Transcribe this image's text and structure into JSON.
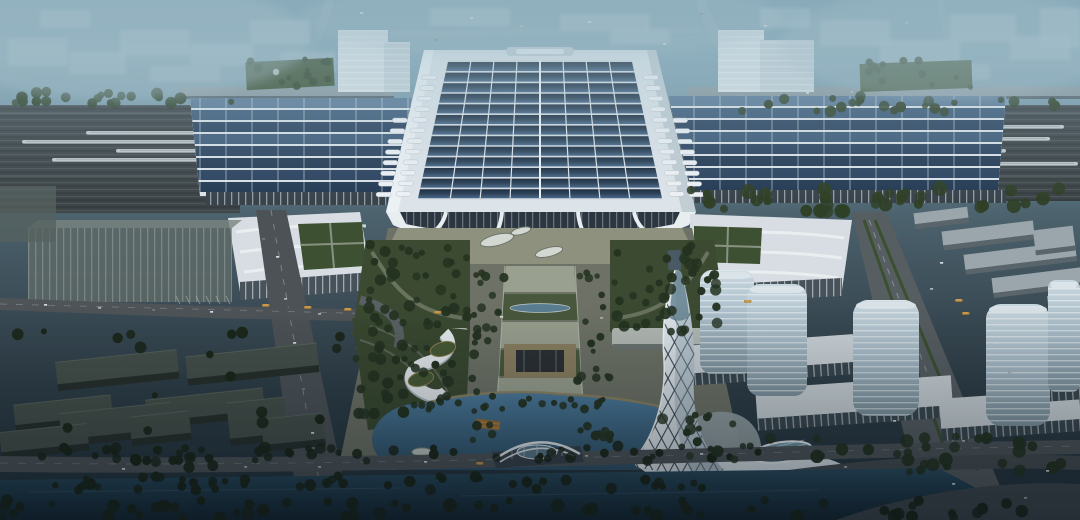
{
  "scene": {
    "title": "Aerial dusk rendering of a high-speed railway station complex",
    "landmarks": [
      "railway-station-hall",
      "solar-panel-roof",
      "side-platform-wings",
      "railway-tracks-with-trains",
      "flanking-office-buildings",
      "wave-roof-annexes",
      "central-garden-axis",
      "landscaped-lake",
      "arch-footbridge",
      "twisted-lattice-tower",
      "glass-high-rise-towers",
      "warehouse-district",
      "canal",
      "hazy-city-skyline"
    ]
  },
  "palette": {
    "sky_top": "#6f93a4",
    "haze_block": "#a9bfca",
    "track_bed": "#3d4447",
    "train_white": "#ced4d8",
    "roof_white": "#dde4e9",
    "panel_dark": "#2d4460",
    "panel_light": "#5c7a97",
    "glass_dark": "#2b3640",
    "garden_green": "#3b4a31",
    "tree_dark": "#243220",
    "tree_mid": "#2f4026",
    "tree_black": "#1a2518",
    "plaza_grey": "#6e7266",
    "axis_pale": "#9aa08f",
    "road_grey": "#4e5457",
    "lake_blue": "#4e7c9e",
    "canal_dark": "#1f3a4a",
    "tower_glass": "#a8bcc8",
    "white_building": "#d9e1e6",
    "lattice_white": "#e6edf1",
    "bus_orange": "#b5822f",
    "pond_blue": "#5d8196"
  },
  "station": {
    "solar_rows": 13,
    "solar_cols": 8,
    "wing_rows": 8,
    "axis": {
      "top": 266,
      "bottom": 462,
      "segments": 7
    }
  },
  "trains": [
    {
      "x": 86,
      "y": 131,
      "w": 212
    },
    {
      "x": 22,
      "y": 140,
      "w": 198
    },
    {
      "x": 116,
      "y": 149,
      "w": 212
    },
    {
      "x": 52,
      "y": 158,
      "w": 168
    },
    {
      "x": 884,
      "y": 125,
      "w": 180
    },
    {
      "x": 798,
      "y": 137,
      "w": 252
    },
    {
      "x": 748,
      "y": 149,
      "w": 258
    },
    {
      "x": 842,
      "y": 162,
      "w": 236
    }
  ],
  "haze_blocks": [
    {
      "x": 8,
      "y": 38,
      "w": 60,
      "h": 28
    },
    {
      "x": 70,
      "y": 52,
      "w": 56,
      "h": 22
    },
    {
      "x": 120,
      "y": 30,
      "w": 70,
      "h": 26
    },
    {
      "x": 190,
      "y": 44,
      "w": 64,
      "h": 22
    },
    {
      "x": 250,
      "y": 20,
      "w": 60,
      "h": 24
    },
    {
      "x": 280,
      "y": 52,
      "w": 56,
      "h": 20
    },
    {
      "x": 150,
      "y": 66,
      "w": 70,
      "h": 16
    },
    {
      "x": 40,
      "y": 10,
      "w": 50,
      "h": 18
    },
    {
      "x": 430,
      "y": 8,
      "w": 80,
      "h": 18
    },
    {
      "x": 560,
      "y": 14,
      "w": 90,
      "h": 16
    },
    {
      "x": 610,
      "y": 30,
      "w": 60,
      "h": 14
    },
    {
      "x": 820,
      "y": 20,
      "w": 70,
      "h": 26
    },
    {
      "x": 880,
      "y": 40,
      "w": 80,
      "h": 24
    },
    {
      "x": 950,
      "y": 14,
      "w": 66,
      "h": 28
    },
    {
      "x": 1010,
      "y": 36,
      "w": 60,
      "h": 24
    },
    {
      "x": 900,
      "y": 64,
      "w": 90,
      "h": 16
    },
    {
      "x": 1040,
      "y": 8,
      "w": 40,
      "h": 40
    },
    {
      "x": 760,
      "y": 8,
      "w": 50,
      "h": 20
    }
  ],
  "towers": [
    {
      "x": 700,
      "y": 270,
      "w": 54,
      "h": 104,
      "r": 12
    },
    {
      "x": 747,
      "y": 284,
      "w": 60,
      "h": 112,
      "r": 13
    },
    {
      "x": 853,
      "y": 300,
      "w": 66,
      "h": 116,
      "r": 15
    },
    {
      "x": 986,
      "y": 304,
      "w": 64,
      "h": 122,
      "r": 15
    },
    {
      "x": 1048,
      "y": 280,
      "w": 32,
      "h": 112,
      "r": 8
    }
  ],
  "podiums": [
    {
      "x": 684,
      "y": 340,
      "w": 170,
      "h": 28
    },
    {
      "x": 756,
      "y": 382,
      "w": 196,
      "h": 30
    },
    {
      "x": 940,
      "y": 394,
      "w": 140,
      "h": 30
    },
    {
      "x": 1002,
      "y": 368,
      "w": 78,
      "h": 22
    }
  ],
  "warehouses": [
    {
      "x": 942,
      "y": 226,
      "w": 92,
      "h": 14
    },
    {
      "x": 964,
      "y": 248,
      "w": 112,
      "h": 15
    },
    {
      "x": 992,
      "y": 272,
      "w": 102,
      "h": 15
    },
    {
      "x": 1034,
      "y": 228,
      "w": 40,
      "h": 20
    },
    {
      "x": 1048,
      "y": 294,
      "w": 32,
      "h": 18
    },
    {
      "x": 914,
      "y": 210,
      "w": 54,
      "h": 11
    }
  ],
  "slabs": [
    {
      "x": 56,
      "y": 356,
      "w": 122,
      "h": 22
    },
    {
      "x": 186,
      "y": 350,
      "w": 132,
      "h": 22
    },
    {
      "x": 146,
      "y": 394,
      "w": 118,
      "h": 22
    },
    {
      "x": 14,
      "y": 400,
      "w": 98,
      "h": 20
    },
    {
      "x": 60,
      "y": 408,
      "w": 112,
      "h": 26
    },
    {
      "x": 228,
      "y": 400,
      "w": 58,
      "h": 36
    },
    {
      "x": 262,
      "y": 416,
      "w": 62,
      "h": 26
    },
    {
      "x": 0,
      "y": 428,
      "w": 88,
      "h": 20
    },
    {
      "x": 130,
      "y": 414,
      "w": 60,
      "h": 22
    }
  ],
  "tree_clusters": [
    {
      "x": 0,
      "y": 90,
      "w": 240,
      "h": 14,
      "n": 22,
      "r0": 3,
      "r1": 6,
      "c": "m"
    },
    {
      "x": 700,
      "y": 96,
      "w": 380,
      "h": 16,
      "n": 24,
      "r0": 3,
      "r1": 6,
      "c": "m"
    },
    {
      "x": 688,
      "y": 188,
      "w": 392,
      "h": 24,
      "n": 34,
      "r0": 4,
      "r1": 8,
      "c": "m"
    },
    {
      "x": 362,
      "y": 244,
      "w": 106,
      "h": 88,
      "n": 40,
      "r0": 3,
      "r1": 6,
      "c": "d"
    },
    {
      "x": 614,
      "y": 244,
      "w": 104,
      "h": 88,
      "n": 40,
      "r0": 3,
      "r1": 6,
      "c": "d"
    },
    {
      "x": 472,
      "y": 268,
      "w": 34,
      "h": 186,
      "n": 26,
      "r0": 2.5,
      "r1": 5,
      "c": "d"
    },
    {
      "x": 576,
      "y": 268,
      "w": 34,
      "h": 186,
      "n": 26,
      "r0": 2.5,
      "r1": 5,
      "c": "d"
    },
    {
      "x": 354,
      "y": 334,
      "w": 108,
      "h": 84,
      "n": 34,
      "r0": 3,
      "r1": 6,
      "c": "d"
    },
    {
      "x": 432,
      "y": 396,
      "w": 196,
      "h": 12,
      "n": 18,
      "r0": 2.5,
      "r1": 4.5,
      "c": "d"
    },
    {
      "x": 0,
      "y": 446,
      "w": 770,
      "h": 16,
      "n": 56,
      "r0": 3,
      "r1": 6,
      "c": "k"
    },
    {
      "x": 0,
      "y": 476,
      "w": 710,
      "h": 14,
      "n": 48,
      "r0": 3,
      "r1": 6,
      "c": "k"
    },
    {
      "x": 0,
      "y": 500,
      "w": 1030,
      "h": 18,
      "n": 60,
      "r0": 3,
      "r1": 7,
      "c": "k"
    },
    {
      "x": 770,
      "y": 436,
      "w": 300,
      "h": 36,
      "n": 30,
      "r0": 3.5,
      "r1": 7,
      "c": "d"
    },
    {
      "x": 0,
      "y": 330,
      "w": 340,
      "h": 160,
      "n": 26,
      "r0": 3,
      "r1": 6,
      "c": "k"
    },
    {
      "x": 240,
      "y": 56,
      "w": 92,
      "h": 30,
      "n": 12,
      "r0": 2.5,
      "r1": 5,
      "c": "m"
    },
    {
      "x": 856,
      "y": 60,
      "w": 120,
      "h": 30,
      "n": 12,
      "r0": 2.5,
      "r1": 5,
      "c": "m"
    },
    {
      "x": 660,
      "y": 412,
      "w": 100,
      "h": 50,
      "n": 16,
      "r0": 3,
      "r1": 6,
      "c": "d"
    }
  ],
  "cars": [
    {
      "x": 470,
      "y": 17,
      "c": 0
    },
    {
      "x": 520,
      "y": 25,
      "c": 1
    },
    {
      "x": 588,
      "y": 21,
      "c": 0
    },
    {
      "x": 645,
      "y": 29,
      "c": 1
    },
    {
      "x": 700,
      "y": 13,
      "c": 2
    },
    {
      "x": 764,
      "y": 25,
      "c": 0
    },
    {
      "x": 822,
      "y": 33,
      "c": 1
    },
    {
      "x": 434,
      "y": 39,
      "c": 2
    },
    {
      "x": 663,
      "y": 43,
      "c": 0
    },
    {
      "x": 905,
      "y": 22,
      "c": 1
    },
    {
      "x": 360,
      "y": 12,
      "c": 0
    },
    {
      "x": 806,
      "y": 92,
      "c": 0
    },
    {
      "x": 850,
      "y": 91,
      "c": 1
    },
    {
      "x": 44,
      "y": 304,
      "c": 0
    },
    {
      "x": 98,
      "y": 307,
      "c": 1
    },
    {
      "x": 152,
      "y": 309,
      "c": 2
    },
    {
      "x": 210,
      "y": 311,
      "c": 0
    },
    {
      "x": 318,
      "y": 313,
      "c": 1
    },
    {
      "x": 500,
      "y": 316,
      "c": 0
    },
    {
      "x": 600,
      "y": 317,
      "c": 1
    },
    {
      "x": 276,
      "y": 256,
      "c": 0
    },
    {
      "x": 284,
      "y": 298,
      "c": 1
    },
    {
      "x": 293,
      "y": 342,
      "c": 0
    },
    {
      "x": 302,
      "y": 388,
      "c": 2
    },
    {
      "x": 311,
      "y": 432,
      "c": 0
    },
    {
      "x": 318,
      "y": 466,
      "c": 1
    },
    {
      "x": 262,
      "y": 238,
      "c": 2
    },
    {
      "x": 122,
      "y": 468,
      "c": 0
    },
    {
      "x": 244,
      "y": 466,
      "c": 1
    },
    {
      "x": 424,
      "y": 461,
      "c": 0
    },
    {
      "x": 585,
      "y": 455,
      "c": 1
    },
    {
      "x": 700,
      "y": 453,
      "c": 0
    },
    {
      "x": 844,
      "y": 466,
      "c": 1
    },
    {
      "x": 952,
      "y": 483,
      "c": 0
    },
    {
      "x": 1024,
      "y": 497,
      "c": 1
    },
    {
      "x": 940,
      "y": 262,
      "c": 0
    },
    {
      "x": 930,
      "y": 288,
      "c": 1
    },
    {
      "x": 994,
      "y": 342,
      "c": 0
    },
    {
      "x": 1008,
      "y": 372,
      "c": 1
    },
    {
      "x": 893,
      "y": 420,
      "c": 0
    },
    {
      "x": 962,
      "y": 440,
      "c": 1
    },
    {
      "x": 1046,
      "y": 470,
      "c": 0
    }
  ],
  "buses": [
    {
      "x": 262,
      "y": 304
    },
    {
      "x": 304,
      "y": 306
    },
    {
      "x": 344,
      "y": 308
    },
    {
      "x": 434,
      "y": 311
    },
    {
      "x": 955,
      "y": 299
    },
    {
      "x": 962,
      "y": 312
    },
    {
      "x": 476,
      "y": 462
    },
    {
      "x": 744,
      "y": 300
    }
  ]
}
